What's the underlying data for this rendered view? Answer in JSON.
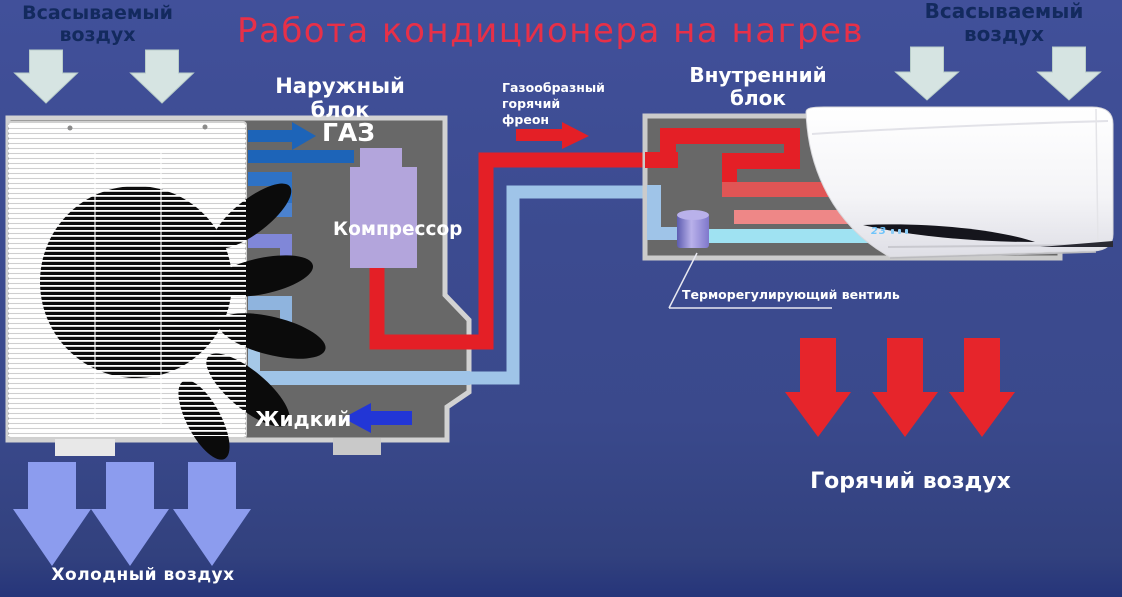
{
  "title": "Работа кондиционера на нагрев",
  "labels": {
    "intake_air": "Всасываемый воздух",
    "outdoor_unit": "Наружный блок",
    "indoor_unit": "Внутренний блок",
    "gas": "ГАЗ",
    "compressor": "Компрессор",
    "freon": "Газообразный\nгорячий\nфреон",
    "thermo_valve": "Терморегулирующий вентиль",
    "liquid": "Жидкий",
    "hot_air": "Горячий воздух",
    "cold_air": "Холодный воздух"
  },
  "indoor_display": {
    "temperature": "23"
  },
  "colors": {
    "background": "#3b4a8e",
    "title_red": "#e73048",
    "dark_text": "#132a5e",
    "unit_gray": "#686868",
    "unit_border": "#d2d2d2",
    "compressor_lavender": "#b3a5dc",
    "gas_pipe_blue": "#1d64b8",
    "hot_pipe_red": "#e41f26",
    "warm_coil_red": "#e05555",
    "mild_coil_pink": "#ee8787",
    "cold_pipe_cyan": "#9fe2f2",
    "liquid_pipe_blue": "#9fc4e8",
    "valve_purple": "#7f78cc",
    "intake_arrow": "#d6e4e2",
    "cold_arrow": "#8c9cee",
    "hot_arrow": "#e6252b",
    "liquid_arrow_blue": "#2236d6"
  }
}
